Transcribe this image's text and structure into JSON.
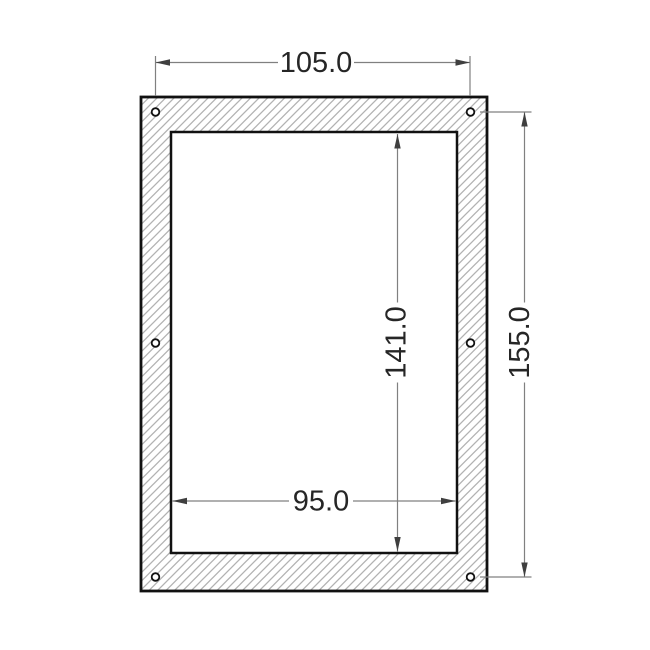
{
  "drawing": {
    "dimensions": {
      "hole_span_horizontal": "105.0",
      "hole_span_vertical": "155.0",
      "opening_height": "141.0",
      "opening_width": "95.0"
    },
    "hole_count": 6,
    "colors": {
      "outline": "#111111",
      "hatch": "#b2b2b2",
      "dimension_line": "#808080",
      "arrow": "#3f3f3f",
      "text": "#262626",
      "background": "#ffffff"
    }
  }
}
